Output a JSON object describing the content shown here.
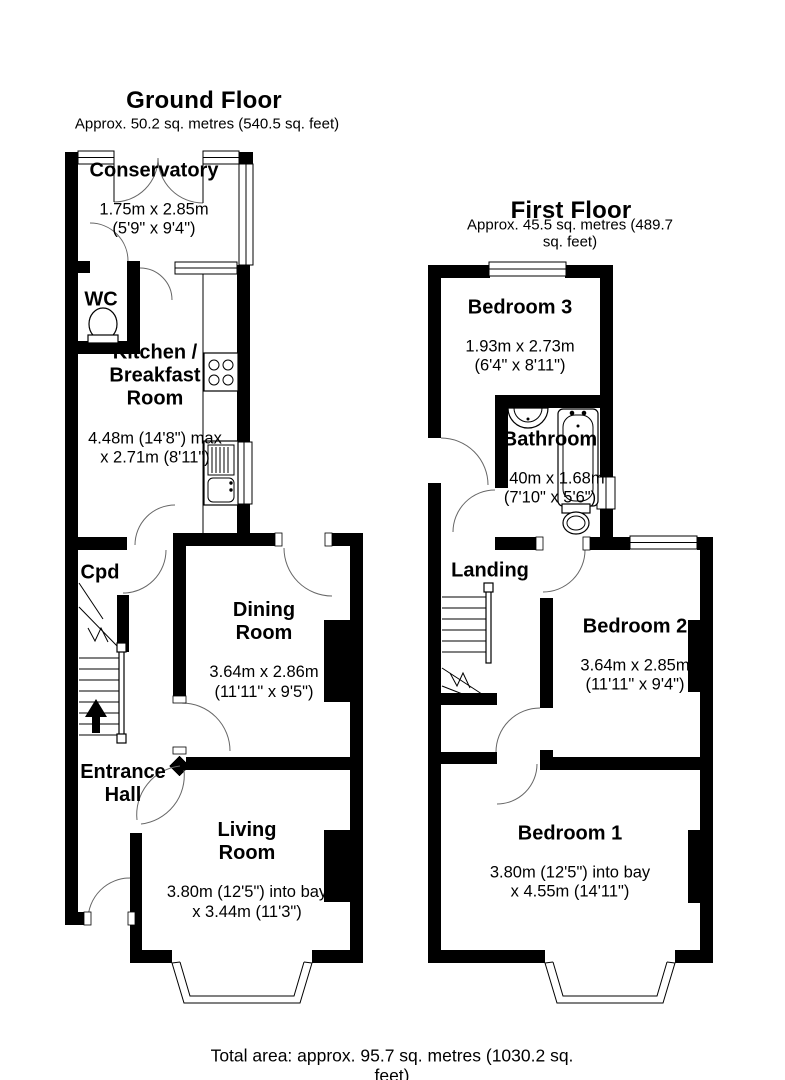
{
  "ground": {
    "title": "Ground Floor",
    "subtitle": "Approx. 50.2 sq. metres (540.5 sq. feet)",
    "rooms": {
      "conservatory": {
        "name": "Conservatory",
        "dims": "1.75m x 2.85m\n(5'9\" x 9'4\")"
      },
      "wc": {
        "name": "WC"
      },
      "kitchen": {
        "name": "Kitchen /\nBreakfast\nRoom",
        "dims": "4.48m (14'8\") max\nx 2.71m (8'11\")"
      },
      "cpd": {
        "name": "Cpd"
      },
      "dining": {
        "name": "Dining\nRoom",
        "dims": "3.64m x 2.86m\n(11'11\" x 9'5\")"
      },
      "hall": {
        "name": "Entrance\nHall"
      },
      "living": {
        "name": "Living\nRoom",
        "dims": "3.80m (12'5\") into bay\nx 3.44m (11'3\")"
      }
    }
  },
  "first": {
    "title": "First Floor",
    "subtitle": "Approx. 45.5 sq. metres (489.7 sq. feet)",
    "rooms": {
      "bedroom3": {
        "name": "Bedroom 3",
        "dims": "1.93m x 2.73m\n(6'4\" x 8'11\")"
      },
      "bathroom": {
        "name": "Bathroom",
        "dims": "2.40m x 1.68m\n(7'10\" x 5'6\")"
      },
      "landing": {
        "name": "Landing"
      },
      "bedroom2": {
        "name": "Bedroom 2",
        "dims": "3.64m x 2.85m\n(11'11\" x 9'4\")"
      },
      "bedroom1": {
        "name": "Bedroom 1",
        "dims": "3.80m (12'5\") into bay\nx 4.55m (14'11\")"
      }
    }
  },
  "footer": {
    "total": "Total area: approx. 95.7 sq. metres (1030.2 sq. feet)"
  },
  "colors": {
    "wall": "#000000",
    "background": "#ffffff",
    "door_arc": "#666666"
  }
}
